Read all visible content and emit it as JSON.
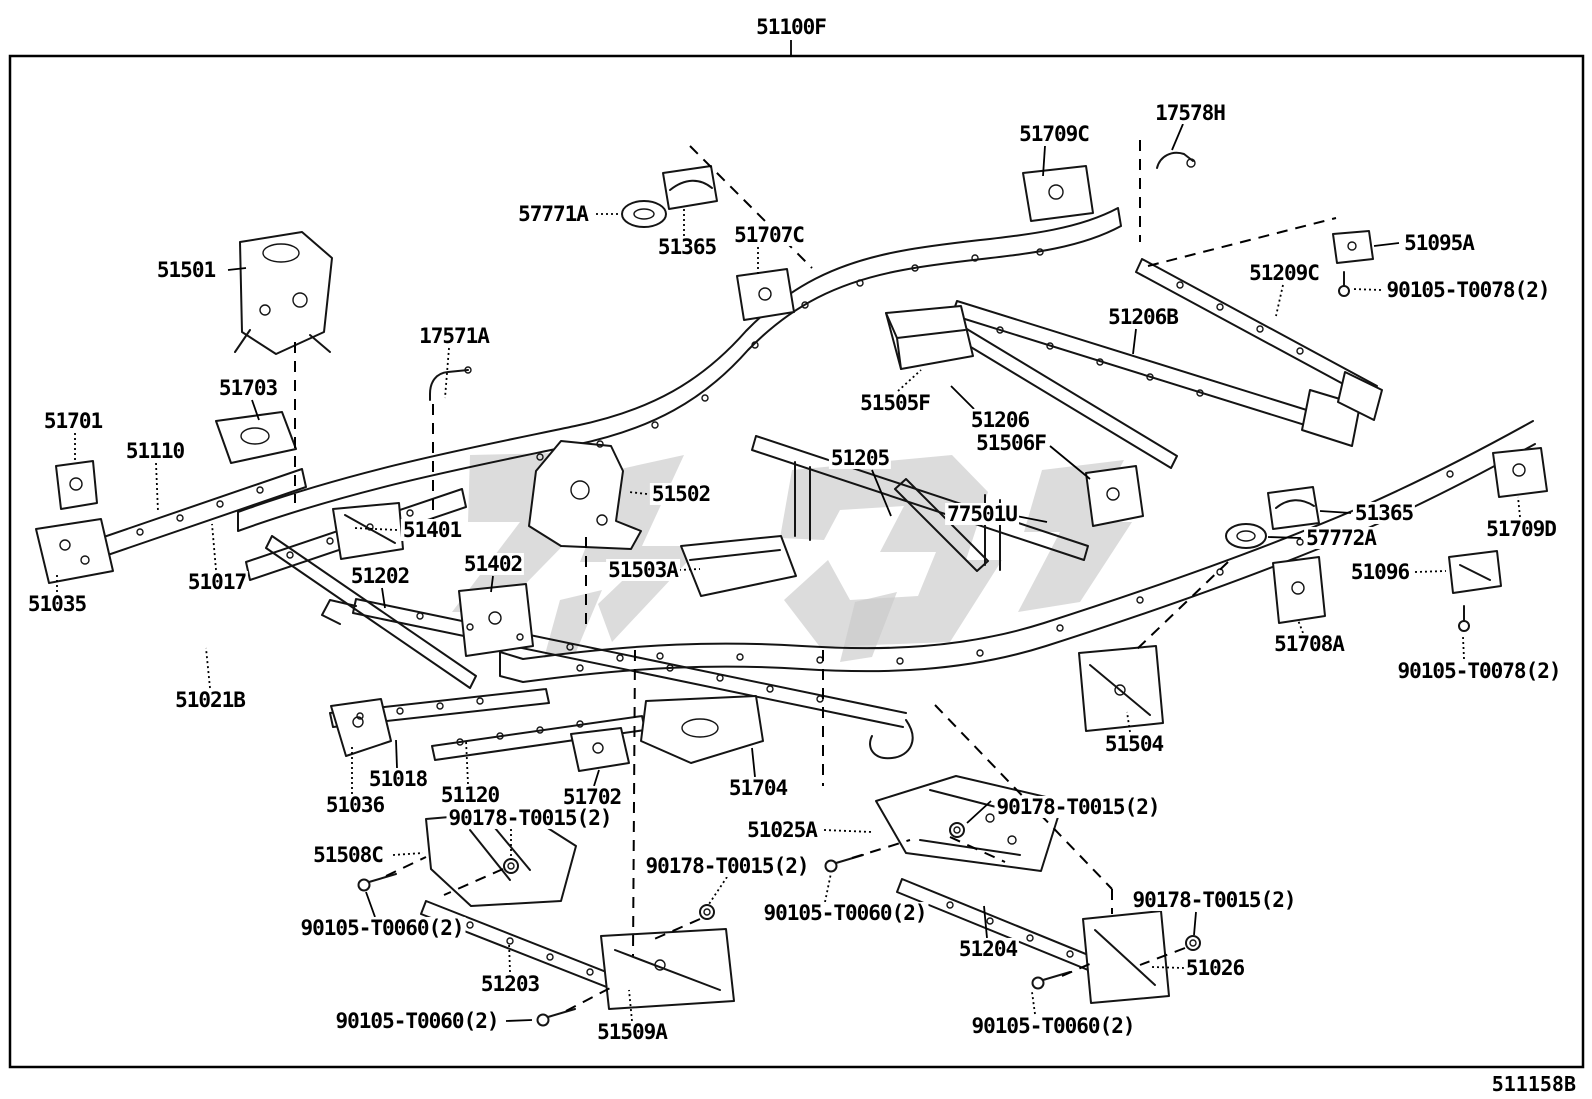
{
  "figure": {
    "title_label": "51100F",
    "sheet_code": "511158B",
    "line_color": "#000000",
    "watermark_color": "#c9c9c9",
    "description": "Frame parts exploded diagram"
  },
  "labels": [
    {
      "text": "51100F",
      "x": 791,
      "y": 27
    },
    {
      "text": "17578H",
      "x": 1190,
      "y": 113
    },
    {
      "text": "51709C",
      "x": 1054,
      "y": 134
    },
    {
      "text": "57771A",
      "x": 553,
      "y": 214
    },
    {
      "text": "51365",
      "x": 687,
      "y": 247
    },
    {
      "text": "51707C",
      "x": 769,
      "y": 235
    },
    {
      "text": "51095A",
      "x": 1439,
      "y": 243
    },
    {
      "text": "90105-T0078(2)",
      "x": 1468,
      "y": 290
    },
    {
      "text": "51209C",
      "x": 1284,
      "y": 273
    },
    {
      "text": "51206B",
      "x": 1143,
      "y": 317
    },
    {
      "text": "51501",
      "x": 186,
      "y": 270
    },
    {
      "text": "17571A",
      "x": 454,
      "y": 336
    },
    {
      "text": "51703",
      "x": 248,
      "y": 388
    },
    {
      "text": "51701",
      "x": 73,
      "y": 421
    },
    {
      "text": "51110",
      "x": 155,
      "y": 451
    },
    {
      "text": "51502",
      "x": 681,
      "y": 494
    },
    {
      "text": "51401",
      "x": 432,
      "y": 530
    },
    {
      "text": "51205",
      "x": 860,
      "y": 458
    },
    {
      "text": "51505F",
      "x": 895,
      "y": 403
    },
    {
      "text": "51206",
      "x": 1000,
      "y": 420
    },
    {
      "text": "51506F",
      "x": 1011,
      "y": 443
    },
    {
      "text": "77501U",
      "x": 982,
      "y": 514
    },
    {
      "text": "51365",
      "x": 1384,
      "y": 513
    },
    {
      "text": "57772A",
      "x": 1341,
      "y": 538
    },
    {
      "text": "51709D",
      "x": 1521,
      "y": 529
    },
    {
      "text": "51402",
      "x": 493,
      "y": 564
    },
    {
      "text": "51503A",
      "x": 643,
      "y": 570
    },
    {
      "text": "51096",
      "x": 1380,
      "y": 572
    },
    {
      "text": "51035",
      "x": 57,
      "y": 604
    },
    {
      "text": "51017",
      "x": 217,
      "y": 582
    },
    {
      "text": "51202",
      "x": 380,
      "y": 576
    },
    {
      "text": "51708A",
      "x": 1309,
      "y": 644
    },
    {
      "text": "90105-T0078(2)",
      "x": 1479,
      "y": 671
    },
    {
      "text": "51021B",
      "x": 210,
      "y": 700
    },
    {
      "text": "51504",
      "x": 1134,
      "y": 744
    },
    {
      "text": "51018",
      "x": 398,
      "y": 779
    },
    {
      "text": "51120",
      "x": 470,
      "y": 795
    },
    {
      "text": "51702",
      "x": 592,
      "y": 797
    },
    {
      "text": "51704",
      "x": 758,
      "y": 788
    },
    {
      "text": "51036",
      "x": 355,
      "y": 805
    },
    {
      "text": "90178-T0015(2)",
      "x": 530,
      "y": 818
    },
    {
      "text": "51025A",
      "x": 782,
      "y": 830
    },
    {
      "text": "90178-T0015(2)",
      "x": 1078,
      "y": 807
    },
    {
      "text": "90178-T0015(2)",
      "x": 727,
      "y": 866
    },
    {
      "text": "90105-T0060(2)",
      "x": 845,
      "y": 913
    },
    {
      "text": "90178-T0015(2)",
      "x": 1214,
      "y": 900
    },
    {
      "text": "51508C",
      "x": 348,
      "y": 855
    },
    {
      "text": "90105-T0060(2)",
      "x": 382,
      "y": 928
    },
    {
      "text": "90105-T0060(2)",
      "x": 417,
      "y": 1021
    },
    {
      "text": "51203",
      "x": 510,
      "y": 984
    },
    {
      "text": "51509A",
      "x": 632,
      "y": 1032
    },
    {
      "text": "51204",
      "x": 988,
      "y": 949
    },
    {
      "text": "51026",
      "x": 1215,
      "y": 968
    },
    {
      "text": "90105-T0060(2)",
      "x": 1053,
      "y": 1026
    }
  ],
  "leaders": [
    {
      "x1": 791,
      "y1": 40,
      "x2": 791,
      "y2": 56,
      "style": "solid"
    },
    {
      "x1": 1183,
      "y1": 124,
      "x2": 1172,
      "y2": 150,
      "style": "solid"
    },
    {
      "x1": 1045,
      "y1": 146,
      "x2": 1043,
      "y2": 176,
      "style": "solid"
    },
    {
      "x1": 596,
      "y1": 214,
      "x2": 620,
      "y2": 214,
      "style": "dotted"
    },
    {
      "x1": 684,
      "y1": 236,
      "x2": 684,
      "y2": 206,
      "style": "dotted"
    },
    {
      "x1": 758,
      "y1": 247,
      "x2": 758,
      "y2": 275,
      "style": "dotted"
    },
    {
      "x1": 1399,
      "y1": 243,
      "x2": 1374,
      "y2": 246,
      "style": "solid"
    },
    {
      "x1": 1381,
      "y1": 290,
      "x2": 1352,
      "y2": 289,
      "style": "dotted"
    },
    {
      "x1": 1283,
      "y1": 285,
      "x2": 1276,
      "y2": 316,
      "style": "dotted"
    },
    {
      "x1": 1136,
      "y1": 329,
      "x2": 1133,
      "y2": 354,
      "style": "solid"
    },
    {
      "x1": 228,
      "y1": 270,
      "x2": 246,
      "y2": 268,
      "style": "solid"
    },
    {
      "x1": 449,
      "y1": 348,
      "x2": 445,
      "y2": 398,
      "style": "dotted"
    },
    {
      "x1": 433,
      "y1": 404,
      "x2": 433,
      "y2": 520,
      "style": "dashed"
    },
    {
      "x1": 252,
      "y1": 400,
      "x2": 259,
      "y2": 420,
      "style": "solid"
    },
    {
      "x1": 75,
      "y1": 433,
      "x2": 75,
      "y2": 463,
      "style": "dotted"
    },
    {
      "x1": 156,
      "y1": 463,
      "x2": 158,
      "y2": 512,
      "style": "dotted"
    },
    {
      "x1": 647,
      "y1": 494,
      "x2": 629,
      "y2": 492,
      "style": "dotted"
    },
    {
      "x1": 397,
      "y1": 530,
      "x2": 354,
      "y2": 528,
      "style": "dotted"
    },
    {
      "x1": 872,
      "y1": 470,
      "x2": 891,
      "y2": 516,
      "style": "solid"
    },
    {
      "x1": 898,
      "y1": 391,
      "x2": 921,
      "y2": 370,
      "style": "dotted"
    },
    {
      "x1": 974,
      "y1": 409,
      "x2": 951,
      "y2": 386,
      "style": "solid"
    },
    {
      "x1": 1050,
      "y1": 446,
      "x2": 1090,
      "y2": 479,
      "style": "solid"
    },
    {
      "x1": 1016,
      "y1": 516,
      "x2": 1047,
      "y2": 522,
      "style": "solid"
    },
    {
      "x1": 1351,
      "y1": 513,
      "x2": 1320,
      "y2": 511,
      "style": "solid"
    },
    {
      "x1": 1301,
      "y1": 538,
      "x2": 1268,
      "y2": 537,
      "style": "solid"
    },
    {
      "x1": 1520,
      "y1": 517,
      "x2": 1518,
      "y2": 497,
      "style": "dotted"
    },
    {
      "x1": 493,
      "y1": 576,
      "x2": 491,
      "y2": 592,
      "style": "solid"
    },
    {
      "x1": 679,
      "y1": 570,
      "x2": 700,
      "y2": 569,
      "style": "dotted"
    },
    {
      "x1": 1415,
      "y1": 572,
      "x2": 1446,
      "y2": 571,
      "style": "dotted"
    },
    {
      "x1": 57,
      "y1": 592,
      "x2": 57,
      "y2": 574,
      "style": "dotted"
    },
    {
      "x1": 216,
      "y1": 570,
      "x2": 212,
      "y2": 524,
      "style": "dotted"
    },
    {
      "x1": 382,
      "y1": 588,
      "x2": 385,
      "y2": 608,
      "style": "solid"
    },
    {
      "x1": 1303,
      "y1": 633,
      "x2": 1298,
      "y2": 620,
      "style": "dotted"
    },
    {
      "x1": 1464,
      "y1": 659,
      "x2": 1463,
      "y2": 637,
      "style": "dotted"
    },
    {
      "x1": 210,
      "y1": 688,
      "x2": 206,
      "y2": 648,
      "style": "dotted"
    },
    {
      "x1": 1130,
      "y1": 732,
      "x2": 1127,
      "y2": 712,
      "style": "dotted"
    },
    {
      "x1": 397,
      "y1": 768,
      "x2": 396,
      "y2": 740,
      "style": "solid"
    },
    {
      "x1": 468,
      "y1": 784,
      "x2": 466,
      "y2": 740,
      "style": "dotted"
    },
    {
      "x1": 594,
      "y1": 786,
      "x2": 599,
      "y2": 770,
      "style": "solid"
    },
    {
      "x1": 755,
      "y1": 777,
      "x2": 752,
      "y2": 748,
      "style": "solid"
    },
    {
      "x1": 352,
      "y1": 794,
      "x2": 352,
      "y2": 744,
      "style": "dotted"
    },
    {
      "x1": 511,
      "y1": 829,
      "x2": 511,
      "y2": 860,
      "style": "dotted"
    },
    {
      "x1": 503,
      "y1": 869,
      "x2": 444,
      "y2": 895,
      "style": "dashed"
    },
    {
      "x1": 824,
      "y1": 830,
      "x2": 872,
      "y2": 832,
      "style": "dotted"
    },
    {
      "x1": 991,
      "y1": 801,
      "x2": 967,
      "y2": 823,
      "style": "solid"
    },
    {
      "x1": 950,
      "y1": 837,
      "x2": 1005,
      "y2": 862,
      "style": "dashed"
    },
    {
      "x1": 727,
      "y1": 877,
      "x2": 709,
      "y2": 904,
      "style": "dotted"
    },
    {
      "x1": 700,
      "y1": 919,
      "x2": 652,
      "y2": 940,
      "style": "dashed"
    },
    {
      "x1": 825,
      "y1": 902,
      "x2": 831,
      "y2": 873,
      "style": "dotted"
    },
    {
      "x1": 852,
      "y1": 858,
      "x2": 910,
      "y2": 840,
      "style": "dashed"
    },
    {
      "x1": 935,
      "y1": 705,
      "x2": 1112,
      "y2": 889,
      "style": "dashed"
    },
    {
      "x1": 1112,
      "y1": 889,
      "x2": 1112,
      "y2": 914,
      "style": "dashed"
    },
    {
      "x1": 1196,
      "y1": 912,
      "x2": 1194,
      "y2": 935,
      "style": "solid"
    },
    {
      "x1": 1185,
      "y1": 948,
      "x2": 1140,
      "y2": 965,
      "style": "dashed"
    },
    {
      "x1": 987,
      "y1": 938,
      "x2": 984,
      "y2": 906,
      "style": "solid"
    },
    {
      "x1": 1184,
      "y1": 968,
      "x2": 1152,
      "y2": 967,
      "style": "dotted"
    },
    {
      "x1": 1035,
      "y1": 1014,
      "x2": 1032,
      "y2": 992,
      "style": "dotted"
    },
    {
      "x1": 1062,
      "y1": 976,
      "x2": 1092,
      "y2": 963,
      "style": "dashed"
    },
    {
      "x1": 375,
      "y1": 917,
      "x2": 366,
      "y2": 892,
      "style": "solid"
    },
    {
      "x1": 386,
      "y1": 876,
      "x2": 426,
      "y2": 857,
      "style": "dashed"
    },
    {
      "x1": 506,
      "y1": 1021,
      "x2": 532,
      "y2": 1020,
      "style": "solid"
    },
    {
      "x1": 566,
      "y1": 1011,
      "x2": 612,
      "y2": 987,
      "style": "dashed"
    },
    {
      "x1": 393,
      "y1": 855,
      "x2": 423,
      "y2": 853,
      "style": "dotted"
    },
    {
      "x1": 510,
      "y1": 972,
      "x2": 509,
      "y2": 942,
      "style": "dotted"
    },
    {
      "x1": 632,
      "y1": 1021,
      "x2": 629,
      "y2": 990,
      "style": "dotted"
    },
    {
      "x1": 690,
      "y1": 146,
      "x2": 812,
      "y2": 268,
      "style": "dashed"
    },
    {
      "x1": 1140,
      "y1": 140,
      "x2": 1140,
      "y2": 242,
      "style": "dashed"
    },
    {
      "x1": 1148,
      "y1": 266,
      "x2": 1336,
      "y2": 218,
      "style": "dashed"
    },
    {
      "x1": 295,
      "y1": 342,
      "x2": 295,
      "y2": 503,
      "style": "dashed"
    },
    {
      "x1": 586,
      "y1": 537,
      "x2": 586,
      "y2": 626,
      "style": "dashed"
    },
    {
      "x1": 635,
      "y1": 650,
      "x2": 633,
      "y2": 956,
      "style": "dashed"
    },
    {
      "x1": 823,
      "y1": 650,
      "x2": 823,
      "y2": 786,
      "style": "dashed"
    },
    {
      "x1": 1228,
      "y1": 562,
      "x2": 1136,
      "y2": 650,
      "style": "dashed"
    }
  ]
}
